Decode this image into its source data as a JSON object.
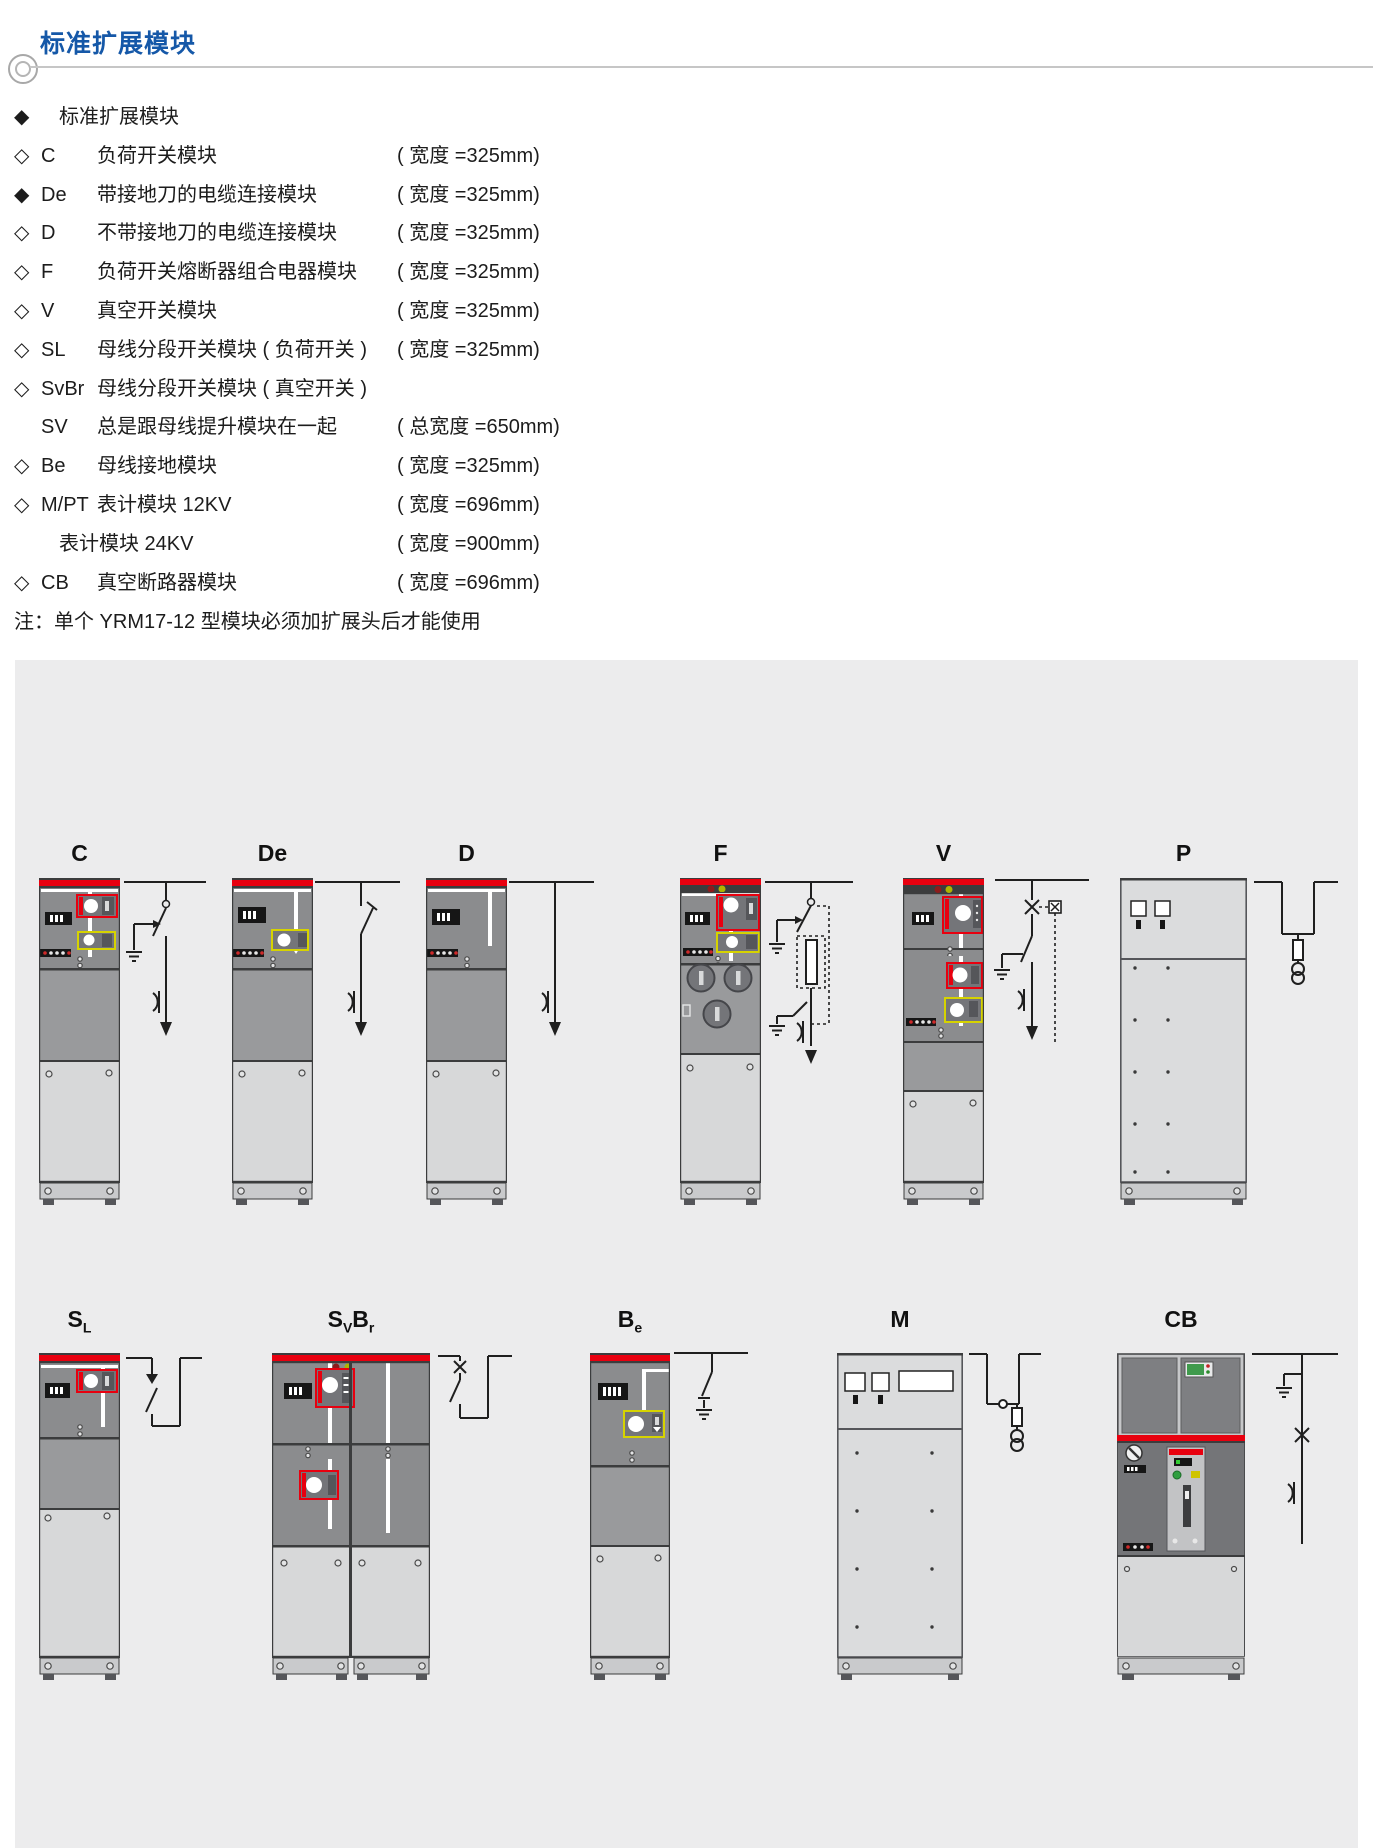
{
  "header": {
    "title": "标准扩展模块",
    "accent_color": "#1558a8"
  },
  "legend": {
    "rows": [
      {
        "marker": "◆",
        "code": "",
        "desc": "标准扩展模块",
        "width": ""
      },
      {
        "marker": "◇",
        "code": "C",
        "desc": "负荷开关模块",
        "width": "( 宽度 =325mm)"
      },
      {
        "marker": "◆",
        "code": "De",
        "desc": "带接地刀的电缆连接模块",
        "width": "( 宽度 =325mm)"
      },
      {
        "marker": "◇",
        "code": "D",
        "desc": "不带接地刀的电缆连接模块",
        "width": "( 宽度 =325mm)"
      },
      {
        "marker": "◇",
        "code": "F",
        "desc": "负荷开关熔断器组合电器模块",
        "width": "( 宽度 =325mm)"
      },
      {
        "marker": "◇",
        "code": "V",
        "desc": "真空开关模块",
        "width": "( 宽度 =325mm)"
      },
      {
        "marker": "◇",
        "code": "SL",
        "desc": "母线分段开关模块 ( 负荷开关 )",
        "width": "( 宽度 =325mm)"
      },
      {
        "marker": "◇",
        "code": "SvBr",
        "desc": "母线分段开关模块 ( 真空开关 )",
        "width": ""
      },
      {
        "marker": "",
        "code": "SV",
        "desc": "总是跟母线提升模块在一起",
        "width": "( 总宽度 =650mm)"
      },
      {
        "marker": "◇",
        "code": "Be",
        "desc": "母线接地模块",
        "width": "( 宽度 =325mm)"
      },
      {
        "marker": "◇",
        "code": "M/PT",
        "desc": "表计模块 12KV",
        "width": "( 宽度 =696mm)"
      },
      {
        "marker": "",
        "code": "",
        "desc": "表计模块 24KV",
        "width": "( 宽度 =900mm)"
      },
      {
        "marker": "◇",
        "code": "CB",
        "desc": "真空断路器模块",
        "width": "( 宽度 =696mm)"
      }
    ],
    "note": "注：单个 YRM17-12 型模块必须加扩展头后才能使用"
  },
  "modules": {
    "c": {
      "label": [
        {
          "t": "C"
        }
      ]
    },
    "de": {
      "label": [
        {
          "t": "De"
        }
      ]
    },
    "d": {
      "label": [
        {
          "t": "D"
        }
      ]
    },
    "f": {
      "label": [
        {
          "t": "F"
        }
      ]
    },
    "v": {
      "label": [
        {
          "t": "V"
        }
      ]
    },
    "p": {
      "label": [
        {
          "t": "P"
        }
      ]
    },
    "sl": {
      "label": [
        {
          "t": "S",
          "sub": "L"
        }
      ]
    },
    "svbr": {
      "label": [
        {
          "t": "S",
          "sub": "V"
        },
        {
          "t": "B",
          "sub": "r"
        }
      ]
    },
    "be": {
      "label": [
        {
          "t": "B",
          "sub": "e"
        }
      ]
    },
    "m": {
      "label": [
        {
          "t": "M"
        }
      ]
    },
    "cb": {
      "label": [
        {
          "t": "CB"
        }
      ]
    }
  },
  "colors": {
    "accent_blue": "#1558a8",
    "cabinet_red": "#e8000f",
    "yellow_frame": "#d6d300",
    "cabinet_gray": "#8b8c8e",
    "panel_background": "#ececed"
  }
}
